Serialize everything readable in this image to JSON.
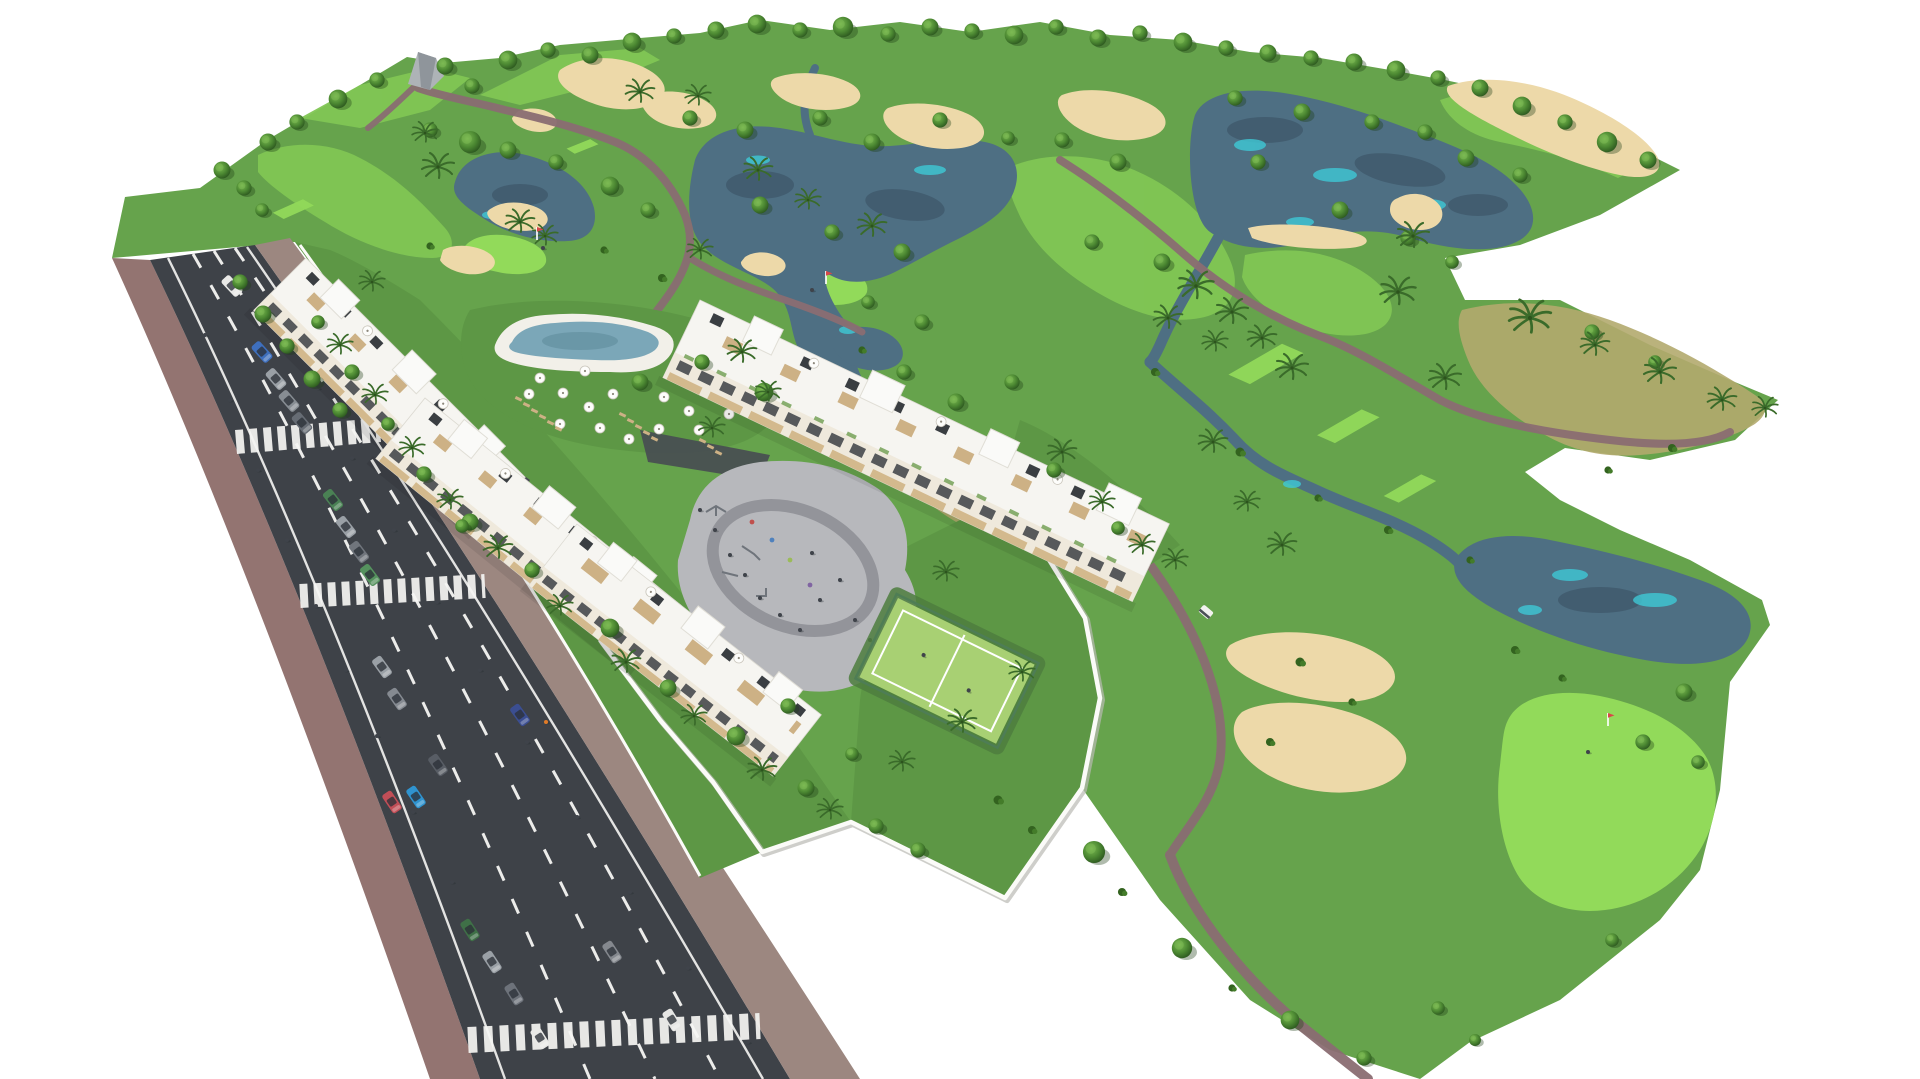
{
  "meta": {
    "title": "Aerial 3D architectural rendering of a golf-resort apartment development",
    "render_type": "isometric aerial visualization, no UI text visible"
  },
  "palette": {
    "background": "#ffffff",
    "grass": "#66a34c",
    "grass_garden": "#5d9745",
    "fairway": "#81c654",
    "green_putting": "#92da5a",
    "scrub": "#b3aa6e",
    "sand": "#edd9a9",
    "water": "#4e6f83",
    "water_deep": "#405a6d",
    "water_teal": "#3fc9d6",
    "path": "#8a6d72",
    "road": "#3e4248",
    "road_mark": "#f5f5f3",
    "sidewalk": "#937471",
    "sidewalk_right": "#9c8780",
    "wall": "#fbfbf8",
    "building": "#f6f5f1",
    "facade": "#efe9dc",
    "window": "#3d4145",
    "wood": "#d3b98d",
    "pergola": "#cdb185",
    "roof_panel": "#3a3e42",
    "pool_deck": "#f2f0e9",
    "pool_water": "#7ba7b8",
    "pool_water_deep": "#64909f",
    "plaza": "#b7b8bc",
    "plaza_ring": "#93949a",
    "court": "#a8d073",
    "fence": "#4e7d55",
    "driveway": "#474b52",
    "umbrella": "#fdfdfb",
    "lounger": "#cdb185",
    "flag_pennant": "#d84848",
    "person": "#3f434a",
    "worker_vest": "#e07b28",
    "monument": "#aeb3b7"
  },
  "scene": {
    "golf_course": {
      "lakes": 5,
      "streams": 3,
      "sand_bunkers": 12,
      "putting_greens_with_flag": 3,
      "tee_boxes": 6,
      "golf_carts": 1,
      "golfers": 3
    },
    "residential": {
      "apartment_blocks": 4,
      "swimming_pool": 1,
      "pool_parasols": 16,
      "sun_loungers": 14,
      "padel_court": 1,
      "playground_plaza": 1,
      "perimeter_walls": 1
    },
    "street": {
      "crosswalks": 3,
      "dashed_lane_lines": 3,
      "pedestrians": 20,
      "cars": [
        {
          "label": "white car parked",
          "color": "#e9e9e7"
        },
        {
          "label": "blue car parked",
          "color": "#3e6fbd"
        },
        {
          "label": "gray car parked",
          "color": "#9aa0a6"
        },
        {
          "label": "gray car parked",
          "color": "#878d93"
        },
        {
          "label": "dark gray car parked",
          "color": "#666c74"
        },
        {
          "label": "green car driving",
          "color": "#55925e"
        },
        {
          "label": "green car parked",
          "color": "#4a8154"
        },
        {
          "label": "gray car parked",
          "color": "#9aa0a6"
        },
        {
          "label": "dark gray car parked",
          "color": "#70757c"
        },
        {
          "label": "gray car parked",
          "color": "#9aa0a6"
        },
        {
          "label": "gray car parked",
          "color": "#858a91"
        },
        {
          "label": "dark gray car parked",
          "color": "#585d65"
        },
        {
          "label": "red car parked",
          "color": "#c24e57"
        },
        {
          "label": "cyan car parked",
          "color": "#2f93cf"
        },
        {
          "label": "dark blue car driving",
          "color": "#3b4e91"
        },
        {
          "label": "dark green car parked",
          "color": "#3f7047"
        },
        {
          "label": "gray car parked",
          "color": "#9aa0a6"
        },
        {
          "label": "dark gray car parked",
          "color": "#6d727a"
        },
        {
          "label": "white car parked",
          "color": "#e9e9e7"
        },
        {
          "label": "gray car driving",
          "color": "#84888e"
        },
        {
          "label": "white car driving",
          "color": "#e6e6e4"
        }
      ]
    }
  }
}
